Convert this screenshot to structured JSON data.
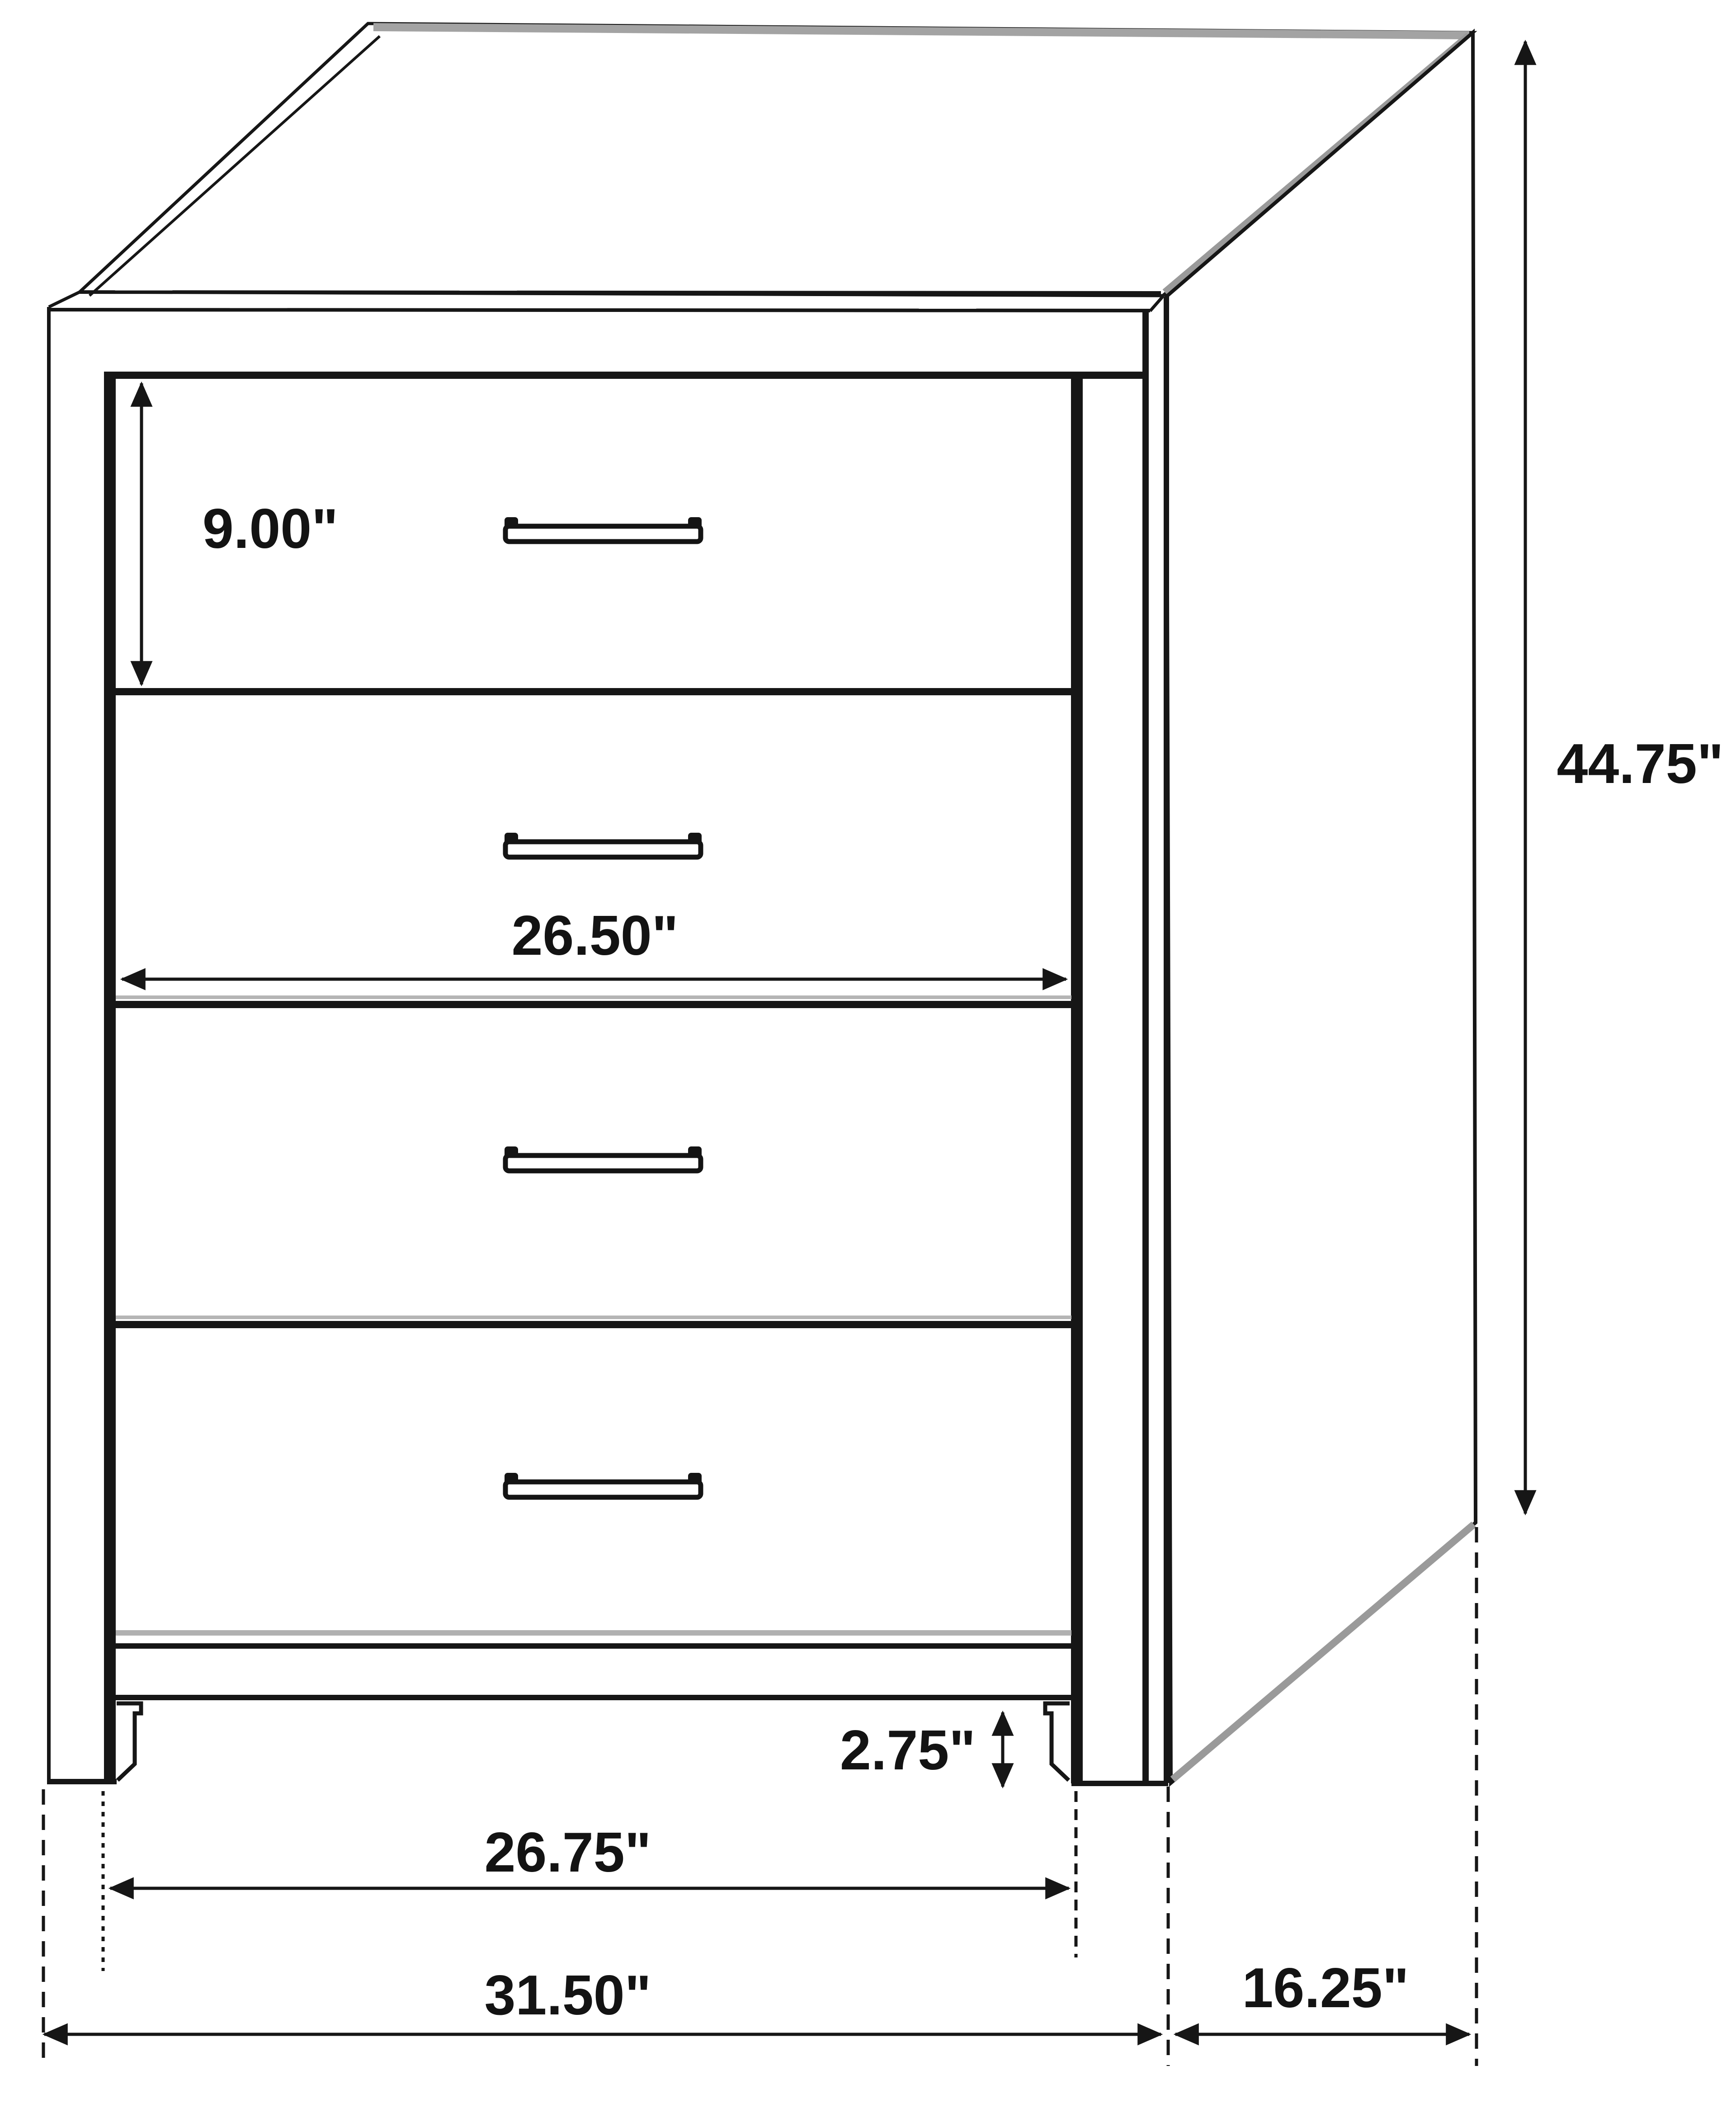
{
  "diagram": {
    "type": "furniture-dimension-drawing",
    "subject": "4-drawer chest of drawers, isometric line drawing",
    "drawer_count": 4,
    "units": "inches"
  },
  "colors": {
    "line": "#161616",
    "edge_highlight_gray": "#a3a3a3",
    "background": "#ffffff",
    "text": "#131313"
  },
  "dimensions": {
    "drawer_height": {
      "name": "top drawer front height",
      "label": "9.00\"",
      "value": 9.0
    },
    "drawer_width": {
      "name": "drawer opening width",
      "label": "26.50\"",
      "value": 26.5
    },
    "overall_height": {
      "name": "overall height",
      "label": "44.75\"",
      "value": 44.75
    },
    "leg_height": {
      "name": "leg / base height",
      "label": "2.75\"",
      "value": 2.75
    },
    "inner_width": {
      "name": "width between stiles",
      "label": "26.75\"",
      "value": 26.75
    },
    "overall_width": {
      "name": "overall width",
      "label": "31.50\"",
      "value": 31.5
    },
    "depth": {
      "name": "side depth",
      "label": "16.25\"",
      "value": 16.25
    }
  }
}
